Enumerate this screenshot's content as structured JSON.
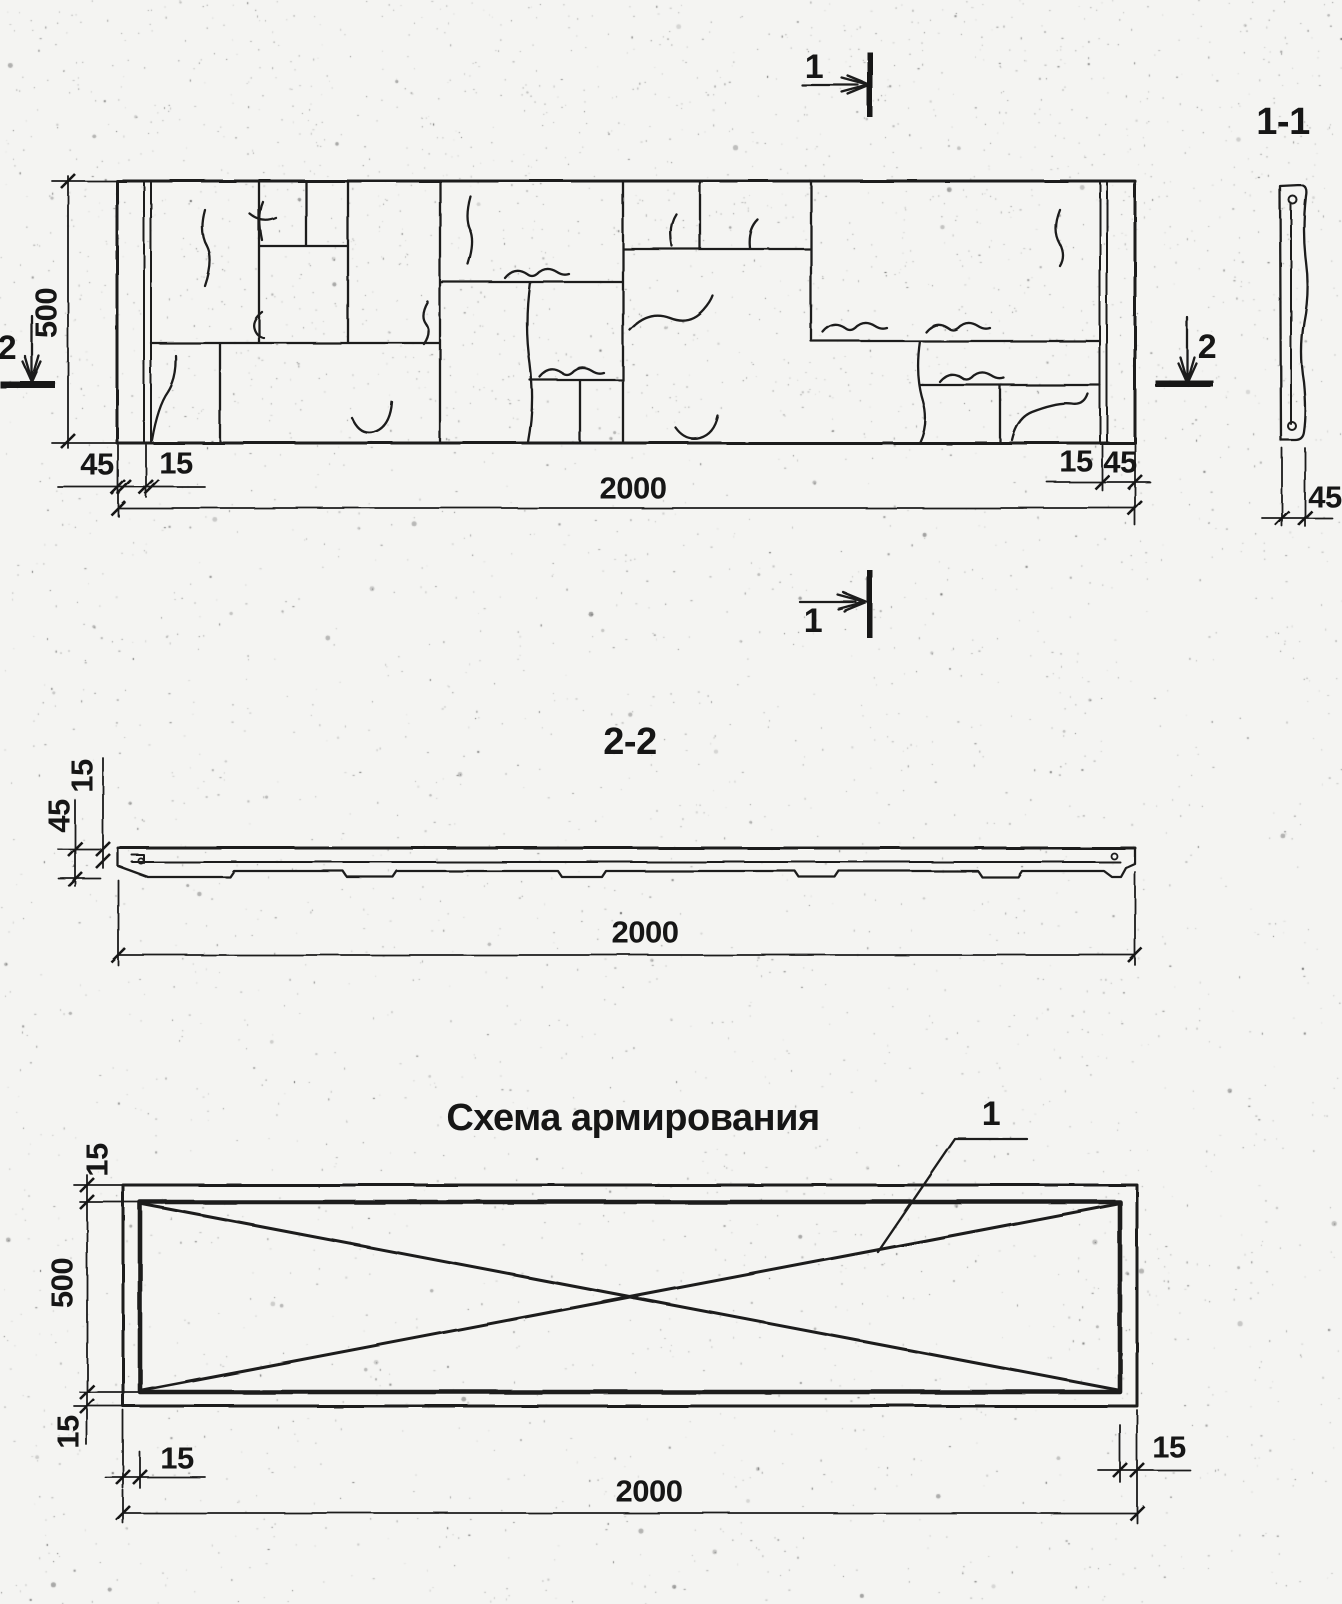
{
  "elevation": {
    "marker_top": "1",
    "marker_bottom": "1",
    "marker_left": "2",
    "marker_right": "2",
    "dim_height": "500",
    "dim_length": "2000",
    "dim_left_margin": "45",
    "dim_left_joint": "15",
    "dim_right_joint": "15",
    "dim_right_margin": "45"
  },
  "section_1_1": {
    "title": "1-1",
    "dim_thickness": "45"
  },
  "section_2_2": {
    "title": "2-2",
    "dim_facing": "15",
    "dim_thickness": "45",
    "dim_length": "2000"
  },
  "reinforcement": {
    "title": "Схема армирования",
    "item_label": "1",
    "dim_height": "500",
    "dim_cover_top": "15",
    "dim_cover_bottom": "15",
    "dim_cover_left": "15",
    "dim_cover_right": "15",
    "dim_length": "2000"
  }
}
